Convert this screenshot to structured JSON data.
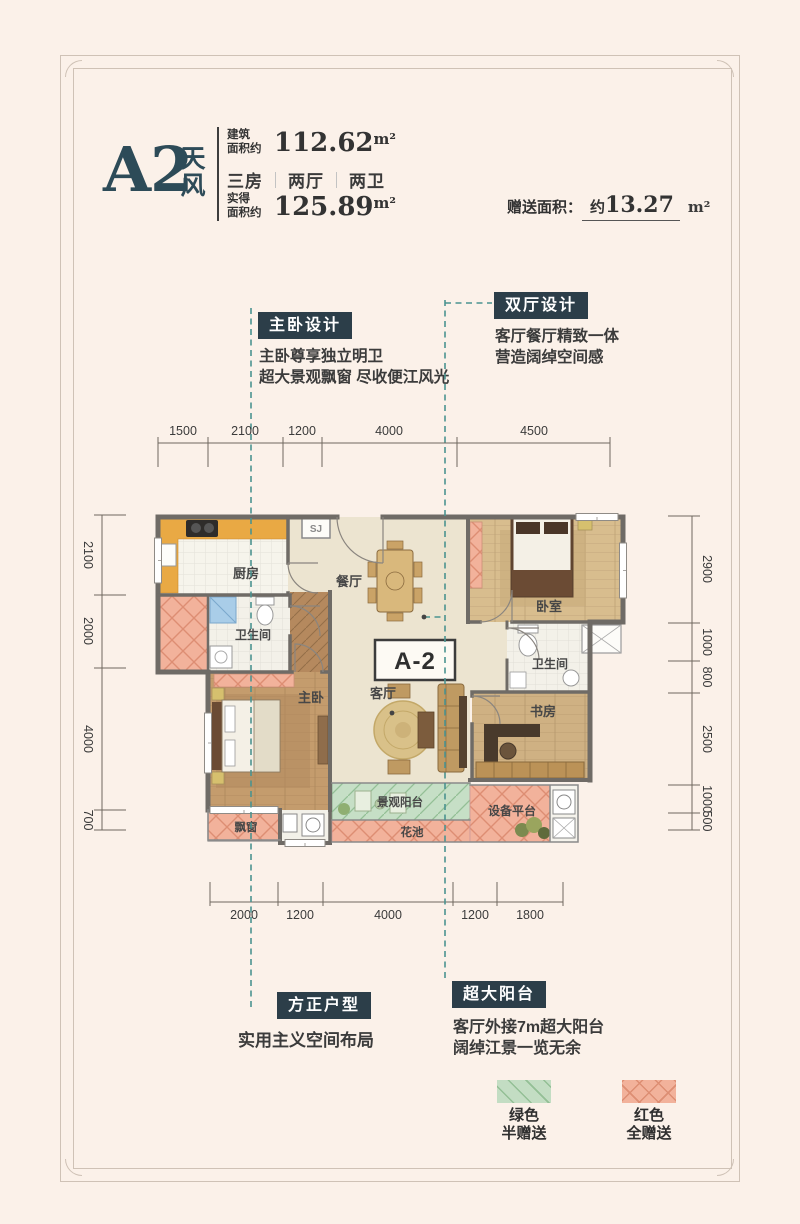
{
  "colors": {
    "page_bg": "#fbf1e9",
    "title": "#2d4b58",
    "badge_bg": "#2c3e49",
    "wall": "#6f6b66",
    "gift_red": "#f2b29b",
    "gift_red_line": "#dd8e73",
    "gift_green": "#c3ddc3",
    "gift_green_line": "#93bf95",
    "dashed_teal": "#4b9390"
  },
  "header": {
    "unit_code": "A2",
    "unit_name_char1": "天",
    "unit_name_char2": "风",
    "area1_label_l1": "建筑",
    "area1_label_l2": "面积约",
    "area1_value": "112.62",
    "area1_unit": "m²",
    "layout_part1": "三房",
    "layout_part2": "两厅",
    "layout_part3": "两卫",
    "area2_label_l1": "实得",
    "area2_label_l2": "面积约",
    "area2_value": "125.89",
    "area2_unit": "m²",
    "gift_label": "赠送面积：",
    "gift_prefix": "约",
    "gift_value": "13.27",
    "gift_unit": "m²"
  },
  "callouts": {
    "master": {
      "badge": "主卧设计",
      "line1": "主卧尊享独立明卫",
      "line2": "超大景观飘窗 尽收便江风光"
    },
    "halls": {
      "badge": "双厅设计",
      "line1": "客厅餐厅精致一体",
      "line2": "营造阔绰空间感"
    },
    "square": {
      "badge": "方正户型",
      "line1": "实用主义空间布局"
    },
    "balcony": {
      "badge": "超大阳台",
      "line1": "客厅外接7m超大阳台",
      "line2": "阔绰江景一览无余"
    }
  },
  "plan": {
    "unit_label": "A-2",
    "labels": {
      "kitchen": "厨房",
      "dining": "餐厅",
      "bath1": "卫生间",
      "master": "主卧",
      "living": "客厅",
      "bedroom": "卧室",
      "bath2": "卫生间",
      "study": "书房",
      "bay": "飘窗",
      "balcony": "景观阳台",
      "flower": "花池",
      "equipment": "设备平台",
      "shaft": "SJ"
    }
  },
  "dimensions": {
    "top": [
      "1500",
      "2100",
      "1200",
      "4000",
      "4500"
    ],
    "bottom": [
      "2000",
      "1200",
      "4000",
      "1200",
      "1800"
    ],
    "left": [
      "2100",
      "2000",
      "4000",
      "700"
    ],
    "right": [
      "2900",
      "1000",
      "800",
      "2500",
      "1000",
      "500"
    ]
  },
  "legend": [
    {
      "label1": "绿色",
      "label2": "半赠送",
      "color": "#c3ddc3"
    },
    {
      "label1": "红色",
      "label2": "全赠送",
      "color": "#f2b29b"
    }
  ]
}
